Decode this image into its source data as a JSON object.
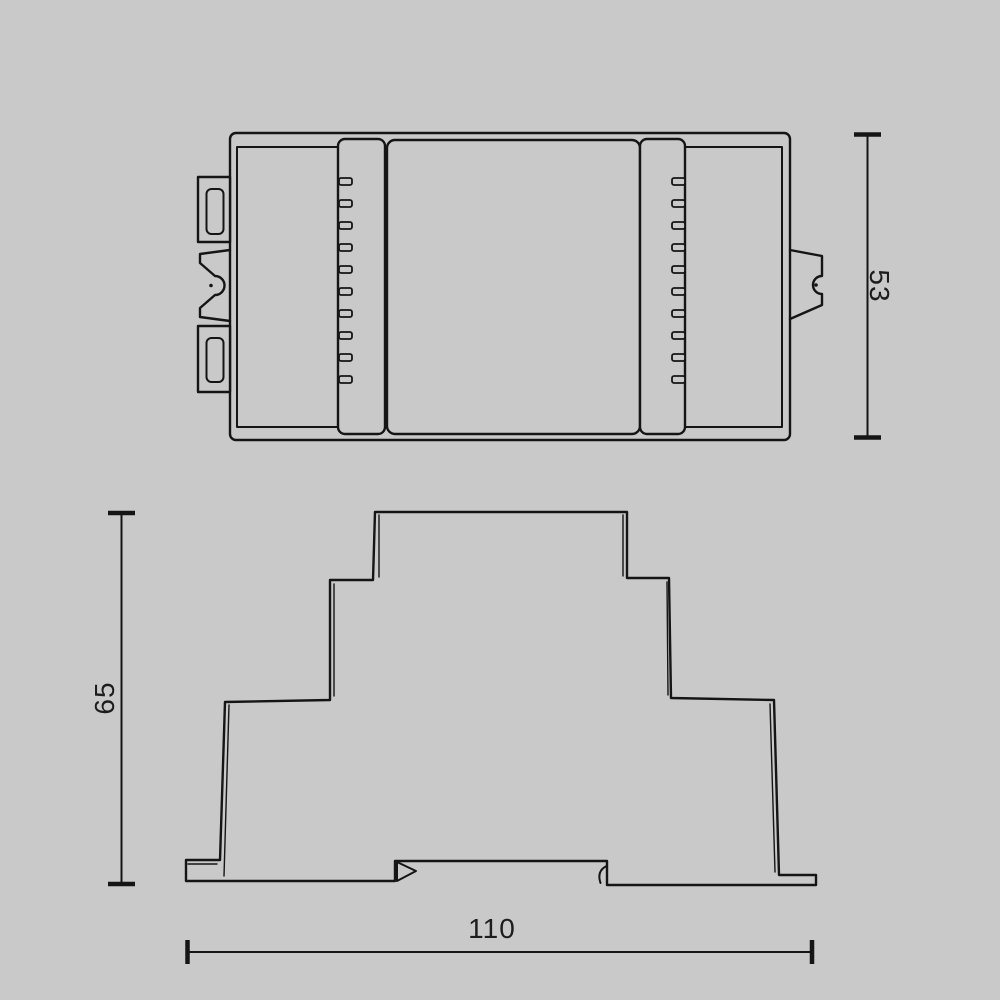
{
  "colors": {
    "background": "#c9c9c9",
    "line": "#151515",
    "text": "#1d1d1d"
  },
  "dimensions": {
    "top_view_height": {
      "value": "53"
    },
    "side_view_height": {
      "value": "65"
    },
    "side_view_width": {
      "value": "110"
    }
  }
}
